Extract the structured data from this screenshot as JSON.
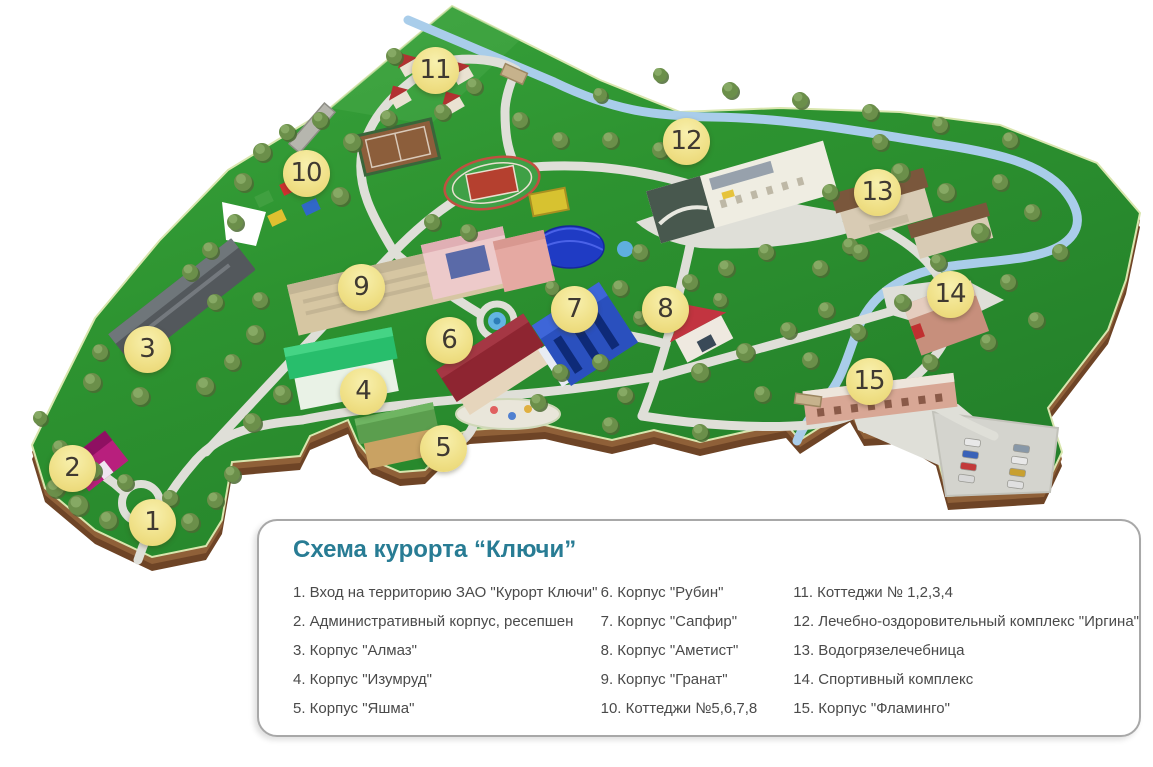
{
  "legend": {
    "title": "Схема курорта “Ключи”",
    "columns": [
      [
        "1. Вход на территорию ЗАО \"Курорт Ключи\"",
        "2. Административный корпус, ресепшен",
        "3. Корпус \"Алмаз\"",
        "4. Корпус \"Изумруд\"",
        "5. Корпус \"Яшма\""
      ],
      [
        "6. Корпус \"Рубин\"",
        "7. Корпус \"Сапфир\"",
        "8. Корпус \"Аметист\"",
        "9. Корпус \"Гранат\"",
        "10. Коттеджи №5,6,7,8"
      ],
      [
        "11. Коттеджи № 1,2,3,4",
        "12. Лечебно-оздоровительный комплекс \"Иргина\"",
        "13. Водогрязелечебница",
        "14. Спортивный комплекс",
        "15. Корпус \"Фламинго\""
      ]
    ]
  },
  "map": {
    "colors": {
      "land": "#2d9330",
      "cliff": "#7f5532",
      "river": "#a9cdea",
      "path": "#dfdfd8",
      "marker_fill": "#f0e189",
      "marker_text": "#3f3931",
      "title_teal": "#287c94"
    },
    "markers": [
      {
        "label": "1",
        "x": 152,
        "y": 522
      },
      {
        "label": "2",
        "x": 72,
        "y": 468
      },
      {
        "label": "3",
        "x": 147,
        "y": 349
      },
      {
        "label": "4",
        "x": 363,
        "y": 391
      },
      {
        "label": "5",
        "x": 443,
        "y": 448
      },
      {
        "label": "6",
        "x": 449,
        "y": 340
      },
      {
        "label": "7",
        "x": 574,
        "y": 309
      },
      {
        "label": "8",
        "x": 665,
        "y": 309
      },
      {
        "label": "9",
        "x": 361,
        "y": 287
      },
      {
        "label": "10",
        "x": 306,
        "y": 173
      },
      {
        "label": "11",
        "x": 435,
        "y": 70
      },
      {
        "label": "12",
        "x": 686,
        "y": 141
      },
      {
        "label": "13",
        "x": 877,
        "y": 192
      },
      {
        "label": "14",
        "x": 950,
        "y": 294
      },
      {
        "label": "15",
        "x": 869,
        "y": 381
      }
    ]
  }
}
